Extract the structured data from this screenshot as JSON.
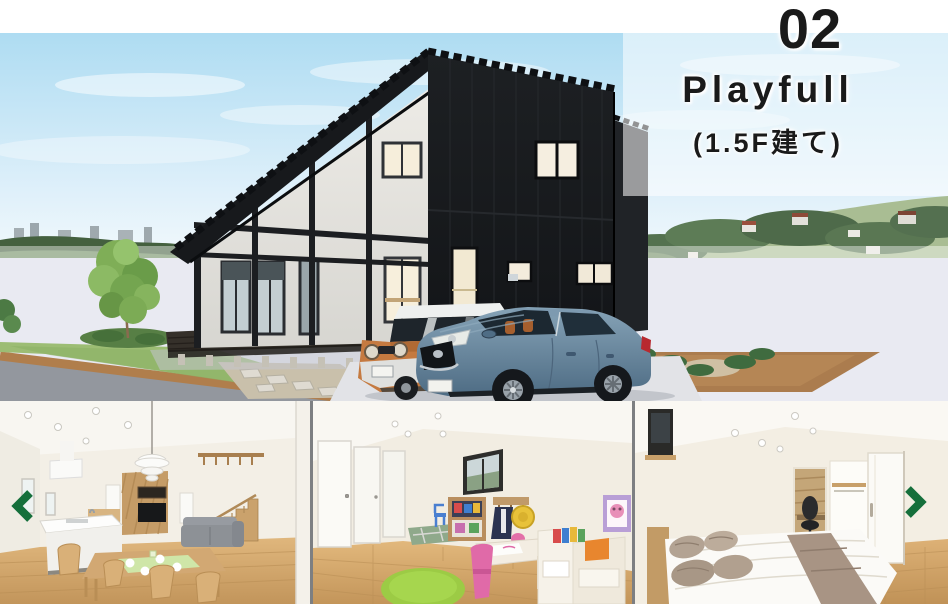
{
  "header": {
    "number": "02",
    "title": "Playfull",
    "subtitle": "(1.5F建て)"
  },
  "theme": {
    "arrow_color": "#156f3b",
    "divider_color": "#7d7f82",
    "label_text_color": "#1a1a1a"
  },
  "carousel": {
    "prev_icon": "chevron-left-icon",
    "next_icon": "chevron-right-icon"
  },
  "gallery": {
    "hero": "exterior-render-black-1.5-story-house-with-orange-and-blue-cars",
    "thumbnails": [
      "interior-living-dining-kitchen",
      "interior-kids-playroom",
      "interior-bedroom"
    ]
  }
}
